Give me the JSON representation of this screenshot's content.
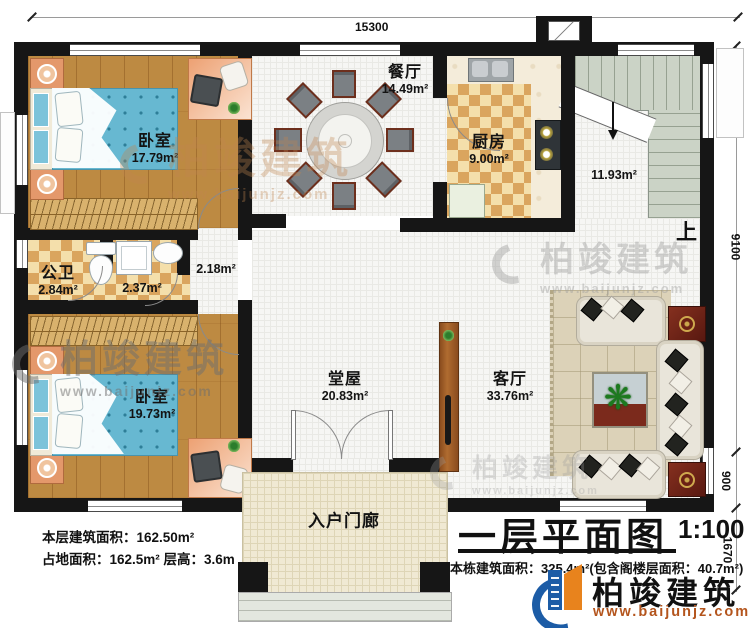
{
  "plan": {
    "title": "一层平面图",
    "scale": "1:100",
    "dims": {
      "top": "15300",
      "right_a": "9100",
      "right_b": "900",
      "right_c": "1670"
    },
    "rooms": {
      "bedroom1": {
        "name": "卧室",
        "area": "17.79m²"
      },
      "bedroom2": {
        "name": "卧室",
        "area": "19.73m²"
      },
      "bath": {
        "name": "公卫",
        "area": "2.84m²"
      },
      "shower": {
        "area": "2.37m²"
      },
      "hallway": {
        "area": "2.18m²"
      },
      "dining": {
        "name": "餐厅",
        "area": "14.49m²"
      },
      "kitchen": {
        "name": "厨房",
        "area": "9.00m²"
      },
      "stairs": {
        "area": "11.93m²",
        "up": "上"
      },
      "tangwu": {
        "name": "堂屋",
        "area": "20.83m²"
      },
      "living": {
        "name": "客厅",
        "area": "33.76m²"
      },
      "porch": {
        "name": "入户门廊"
      }
    },
    "notes": {
      "floor_area": "本层建筑面积：162.50m²",
      "footprint": "占地面积：162.5m² 层高：3.6m",
      "total": "本栋建筑面积：325.4m²(包含阁楼层面积：40.7m²)"
    },
    "brand": {
      "name": "柏竣建筑",
      "url": "www.baijunjz.com"
    }
  }
}
